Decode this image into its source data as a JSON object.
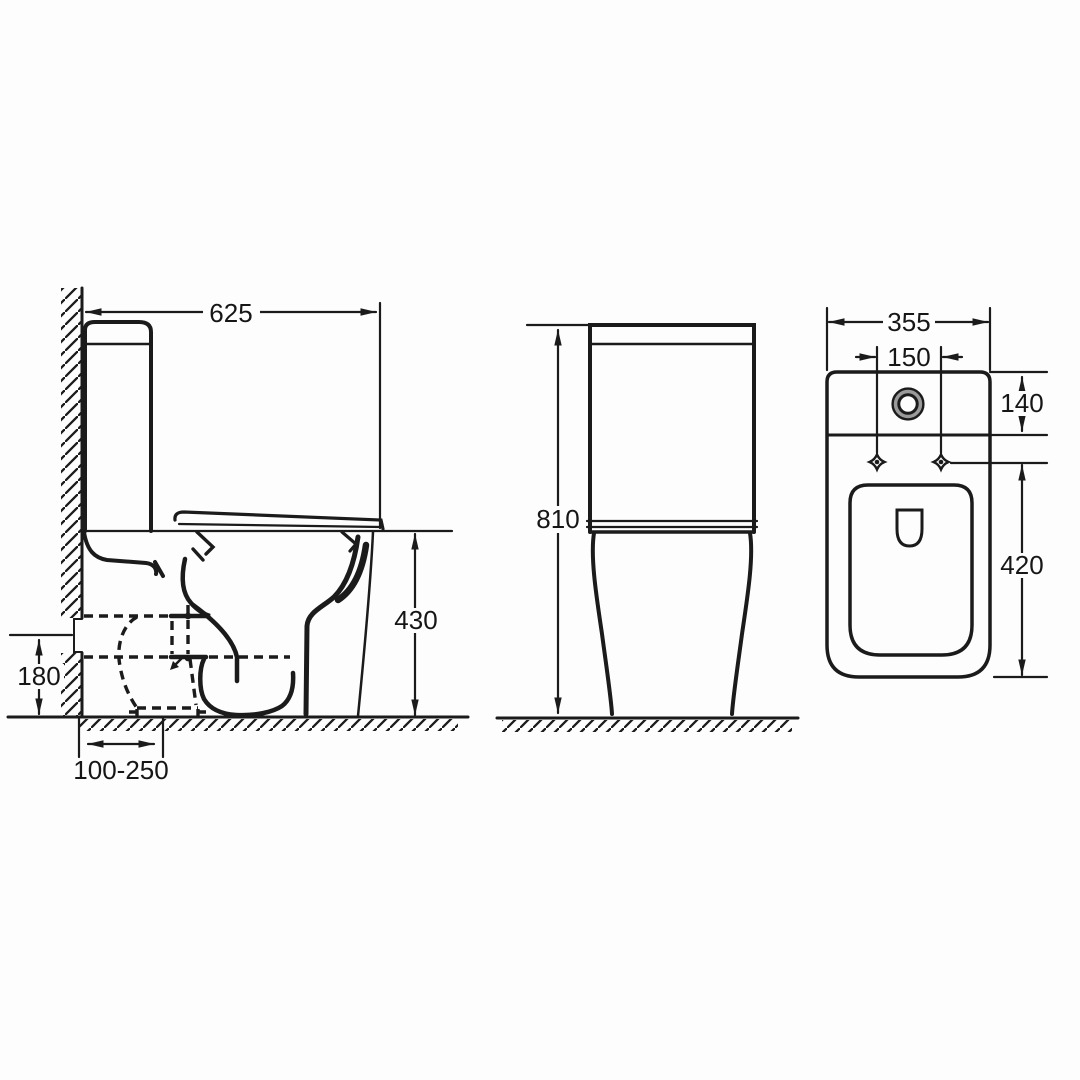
{
  "title": "toilet-technical-drawing",
  "colors": {
    "background": "#fdfdfd",
    "line": "#1b1b1b",
    "shade": "#9a9a9a"
  },
  "views": {
    "side": {
      "label": "side-view",
      "dims": {
        "overall_depth": "625",
        "seat_height": "430",
        "outlet_height": "180",
        "outlet_setout": "100-250"
      }
    },
    "front": {
      "label": "front-view",
      "dims": {
        "overall_height": "810"
      }
    },
    "plan": {
      "label": "plan-view",
      "dims": {
        "overall_width": "355",
        "fixing_hole_spacing": "150",
        "cistern_depth": "140",
        "pan_length": "420"
      }
    }
  }
}
